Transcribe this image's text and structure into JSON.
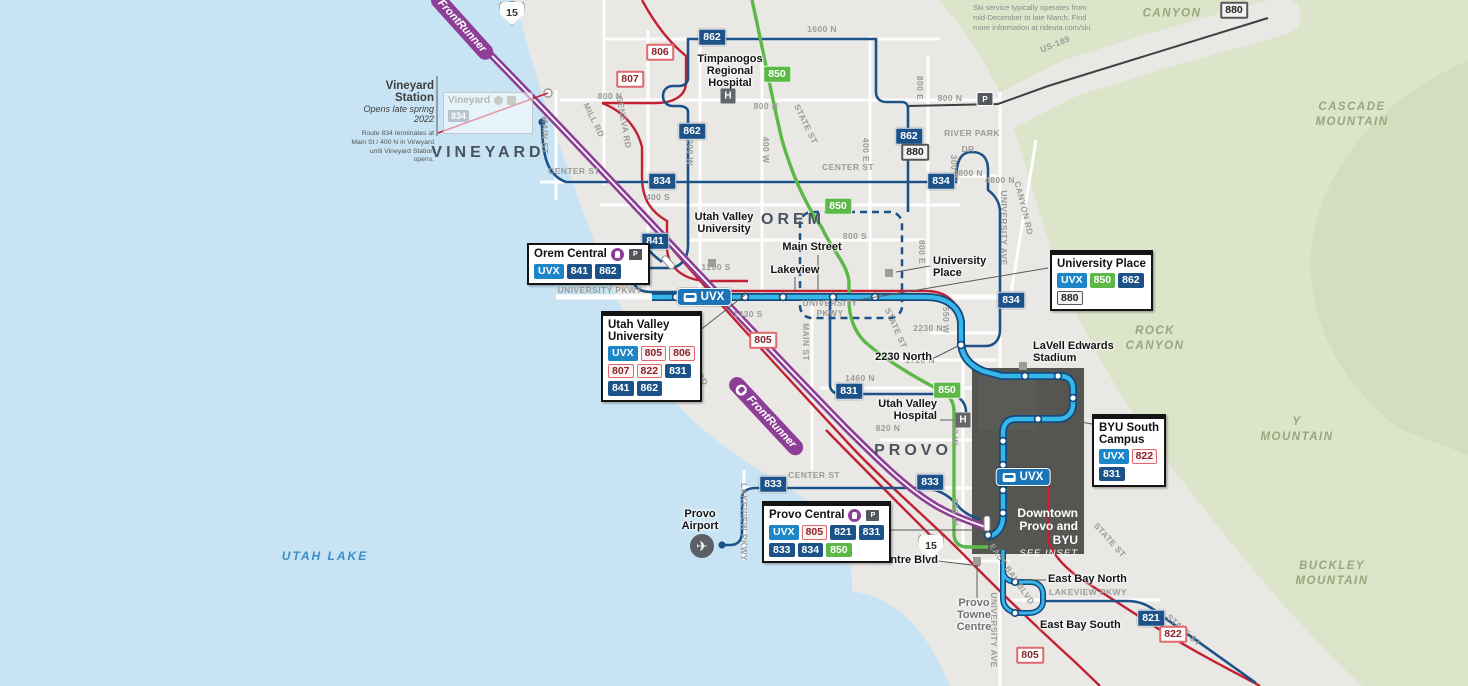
{
  "notes": {
    "ski": "Ski service typically operates from mid-December to late March. Find more information at rideuta.com/ski.",
    "vineyard_title": "Vineyard Station",
    "vineyard_sub": "Opens late spring 2022",
    "vineyard_body": "Route 834 terminates at Main St / 400 N in Vineyard until Vineyard Station opens.",
    "ghost_station": "Vineyard",
    "ghost_badge": "834"
  },
  "interstate": {
    "label": "15"
  },
  "icon_letters": {
    "hospital": "H",
    "airport": "✈"
  },
  "inset": {
    "title": "Downtown\nProvo and\nBYU",
    "see": "SEE INSET"
  },
  "map": {
    "route_styles": {
      "UVX": "uvx",
      "805": "red",
      "806": "red",
      "807": "red",
      "822": "red",
      "850": "green",
      "880": "gray"
    },
    "cities": [
      {
        "l": "VINEYARD",
        "x": 488,
        "y": 153
      },
      {
        "l": "OREM",
        "x": 793,
        "y": 220
      },
      {
        "l": "PROVO",
        "x": 913,
        "y": 451
      }
    ],
    "terrain": [
      {
        "l": "UTAH LAKE",
        "x": 325,
        "y": 557,
        "water": true
      },
      {
        "l": "CANYON",
        "x": 1172,
        "y": 14
      },
      {
        "l": "CASCADE\nMOUNTAIN",
        "x": 1352,
        "y": 115
      },
      {
        "l": "ROCK\nCANYON",
        "x": 1155,
        "y": 339
      },
      {
        "l": "Y\nMOUNTAIN",
        "x": 1297,
        "y": 430
      },
      {
        "l": "BUCKLEY\nMOUNTAIN",
        "x": 1332,
        "y": 574
      }
    ],
    "streets": [
      {
        "l": "1600 N",
        "x": 822,
        "y": 29
      },
      {
        "l": "US-189",
        "x": 1055,
        "y": 44,
        "r": -22
      },
      {
        "l": "800 N",
        "x": 610,
        "y": 96
      },
      {
        "l": "800 N",
        "x": 766,
        "y": 106
      },
      {
        "l": "800 N",
        "x": 950,
        "y": 98
      },
      {
        "l": "MILL RD",
        "x": 594,
        "y": 120,
        "r": 64
      },
      {
        "l": "GENEVA RD",
        "x": 624,
        "y": 122,
        "r": 80
      },
      {
        "l": "MAIN ST",
        "x": 545,
        "y": 135,
        "r": 90
      },
      {
        "l": "1200 W",
        "x": 690,
        "y": 150,
        "r": 90
      },
      {
        "l": "400 W",
        "x": 766,
        "y": 150,
        "r": 90
      },
      {
        "l": "STATE ST",
        "x": 806,
        "y": 124,
        "r": 64
      },
      {
        "l": "400 E",
        "x": 866,
        "y": 150,
        "r": 90
      },
      {
        "l": "800 E",
        "x": 920,
        "y": 88,
        "r": 90
      },
      {
        "l": "800 E",
        "x": 922,
        "y": 252,
        "r": 90
      },
      {
        "l": "CENTER ST",
        "x": 574,
        "y": 171
      },
      {
        "l": "CENTER ST",
        "x": 848,
        "y": 167
      },
      {
        "l": "400 S",
        "x": 658,
        "y": 197
      },
      {
        "l": "800 S",
        "x": 855,
        "y": 236
      },
      {
        "l": "RIVER PARK",
        "x": 972,
        "y": 133
      },
      {
        "l": "DR",
        "x": 968,
        "y": 149
      },
      {
        "l": "4800 N",
        "x": 968,
        "y": 173
      },
      {
        "l": "300 W",
        "x": 954,
        "y": 168,
        "r": 90
      },
      {
        "l": "CANYON RD",
        "x": 1024,
        "y": 208,
        "r": 76
      },
      {
        "l": "UNIVERSITY AVE",
        "x": 1004,
        "y": 228,
        "r": 90
      },
      {
        "l": "UNIVERSITY PKWY",
        "x": 600,
        "y": 290
      },
      {
        "l": "1200 S",
        "x": 716,
        "y": 267
      },
      {
        "l": "1430 S",
        "x": 748,
        "y": 314
      },
      {
        "l": "GENEVA RD",
        "x": 692,
        "y": 362,
        "r": 58
      },
      {
        "l": "MAIN ST",
        "x": 806,
        "y": 342,
        "r": 90
      },
      {
        "l": "UNIVERSITY\nPKWY",
        "x": 830,
        "y": 308
      },
      {
        "l": "STATE ST",
        "x": 896,
        "y": 328,
        "r": 66
      },
      {
        "l": "550 W",
        "x": 946,
        "y": 320,
        "r": 90
      },
      {
        "l": "2230 N",
        "x": 928,
        "y": 328
      },
      {
        "l": "1720 N",
        "x": 920,
        "y": 360
      },
      {
        "l": "1460 N",
        "x": 860,
        "y": 378
      },
      {
        "l": "820 N",
        "x": 888,
        "y": 428
      },
      {
        "l": "500 W",
        "x": 955,
        "y": 432,
        "r": 90
      },
      {
        "l": "500 W",
        "x": 955,
        "y": 512,
        "r": 90
      },
      {
        "l": "CENTER ST",
        "x": 814,
        "y": 475
      },
      {
        "l": "LAKEVIEW PKWY",
        "x": 744,
        "y": 522,
        "r": 90
      },
      {
        "l": "LAKEVIEW PKWY",
        "x": 1088,
        "y": 592
      },
      {
        "l": "EAST BAY BLVD",
        "x": 1012,
        "y": 574,
        "r": 55
      },
      {
        "l": "STATE ST",
        "x": 1110,
        "y": 540,
        "r": 48
      },
      {
        "l": "STATE ST",
        "x": 1184,
        "y": 630,
        "r": 42
      },
      {
        "l": "UNIVERSITY AVE",
        "x": 994,
        "y": 630,
        "r": 90
      },
      {
        "l": "4800 N",
        "x": 1000,
        "y": 180
      }
    ],
    "badges": [
      {
        "r": "880",
        "x": 1234,
        "y": 10
      },
      {
        "r": "862",
        "x": 712,
        "y": 37
      },
      {
        "r": "850",
        "x": 777,
        "y": 74
      },
      {
        "r": "806",
        "x": 660,
        "y": 52
      },
      {
        "r": "807",
        "x": 630,
        "y": 79
      },
      {
        "r": "862",
        "x": 692,
        "y": 131
      },
      {
        "r": "862",
        "x": 909,
        "y": 136
      },
      {
        "r": "880",
        "x": 915,
        "y": 152
      },
      {
        "r": "834",
        "x": 662,
        "y": 181
      },
      {
        "r": "834",
        "x": 941,
        "y": 181
      },
      {
        "r": "850",
        "x": 838,
        "y": 206
      },
      {
        "r": "841",
        "x": 655,
        "y": 241
      },
      {
        "r": "834",
        "x": 1011,
        "y": 300
      },
      {
        "r": "805",
        "x": 763,
        "y": 340
      },
      {
        "r": "831",
        "x": 849,
        "y": 391
      },
      {
        "r": "850",
        "x": 947,
        "y": 390
      },
      {
        "r": "833",
        "x": 773,
        "y": 484
      },
      {
        "r": "833",
        "x": 930,
        "y": 482
      },
      {
        "r": "821",
        "x": 1151,
        "y": 618
      },
      {
        "r": "822",
        "x": 1173,
        "y": 634
      },
      {
        "r": "805",
        "x": 1030,
        "y": 655
      }
    ],
    "uvx_badges": [
      {
        "l": "UVX",
        "x": 704,
        "y": 297
      },
      {
        "l": "UVX",
        "x": 1023,
        "y": 477
      }
    ],
    "frontrunner_bands": [
      {
        "l": "FrontRunner",
        "x": 462,
        "y": 26,
        "r": 48,
        "icon": false
      },
      {
        "l": "FrontRunner",
        "x": 766,
        "y": 416,
        "r": 47,
        "icon": true
      }
    ],
    "stations": [
      {
        "l": "Timpanogos\nRegional\nHospital",
        "x": 730,
        "y": 72,
        "a": "c"
      },
      {
        "l": "Utah Valley\nUniversity",
        "x": 724,
        "y": 224,
        "a": "c"
      },
      {
        "l": "University\nPlace",
        "x": 933,
        "y": 268,
        "a": "l"
      },
      {
        "l": "Main Street",
        "x": 812,
        "y": 248,
        "a": "c"
      },
      {
        "l": "Lakeview",
        "x": 795,
        "y": 271,
        "a": "c"
      },
      {
        "l": "2230 North",
        "x": 932,
        "y": 358,
        "a": "r"
      },
      {
        "l": "LaVell Edwards\nStadium",
        "x": 1033,
        "y": 353,
        "a": "l"
      },
      {
        "l": "Utah Valley\nHospital",
        "x": 937,
        "y": 411,
        "a": "r"
      },
      {
        "l": "Towne Centre Blvd",
        "x": 938,
        "y": 561,
        "a": "r"
      },
      {
        "l": "East Bay North",
        "x": 1048,
        "y": 580,
        "a": "l"
      },
      {
        "l": "East Bay South",
        "x": 1040,
        "y": 626,
        "a": "l"
      },
      {
        "l": "Provo\nAirport",
        "x": 700,
        "y": 521,
        "a": "c"
      },
      {
        "l": "Provo\nTowne\nCentre",
        "x": 974,
        "y": 616,
        "a": "c",
        "gray": true
      }
    ],
    "pois": [
      {
        "t": "hospital",
        "x": 728,
        "y": 96
      },
      {
        "t": "hospital",
        "x": 963,
        "y": 420
      },
      {
        "t": "square",
        "x": 712,
        "y": 263
      },
      {
        "t": "square",
        "x": 889,
        "y": 273
      },
      {
        "t": "square",
        "x": 1023,
        "y": 366
      },
      {
        "t": "square",
        "x": 977,
        "y": 561
      },
      {
        "t": "airport",
        "x": 702,
        "y": 546
      },
      {
        "t": "parkride",
        "x": 985,
        "y": 99
      }
    ],
    "shields": [
      {
        "x": 512,
        "y": 13
      },
      {
        "x": 931,
        "y": 546
      }
    ],
    "boxes": [
      {
        "title": "Orem Central",
        "x": 527,
        "y": 243,
        "icons": true,
        "topbar": false,
        "rows": [
          [
            "UVX",
            "841",
            "862"
          ]
        ]
      },
      {
        "title": "Utah Valley\nUniversity",
        "x": 601,
        "y": 311,
        "icons": false,
        "topbar": true,
        "rows": [
          [
            "UVX",
            "805",
            "806"
          ],
          [
            "807",
            "822",
            "831"
          ],
          [
            "841",
            "862"
          ]
        ]
      },
      {
        "title": "University Place",
        "x": 1050,
        "y": 250,
        "icons": false,
        "topbar": true,
        "rows": [
          [
            "UVX",
            "850",
            "862"
          ],
          [
            "880"
          ]
        ]
      },
      {
        "title": "BYU South\nCampus",
        "x": 1092,
        "y": 414,
        "icons": false,
        "topbar": true,
        "rows": [
          [
            "UVX",
            "822"
          ],
          [
            "831"
          ]
        ]
      },
      {
        "title": "Provo Central",
        "x": 762,
        "y": 501,
        "icons": true,
        "topbar": true,
        "rows": [
          [
            "UVX",
            "805",
            "821",
            "831"
          ],
          [
            "833",
            "834",
            "850"
          ]
        ]
      }
    ]
  }
}
